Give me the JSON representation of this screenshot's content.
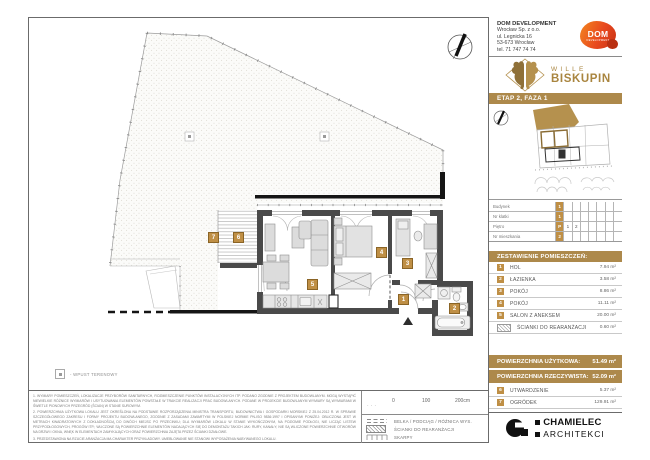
{
  "header": {
    "company_name": "DOM DEVELOPMENT",
    "company_line1": "Wrocław Sp. z o.o.",
    "company_line2": "ul. Legnicka 16",
    "company_line3": "53-673 Wrocław",
    "company_line4": "tel. 71 747 74 74",
    "dom_logo_text": "DOM",
    "dom_logo_sub": "DEVELOPMENT"
  },
  "brand": {
    "line1": "WILLE",
    "line2": "BISKUPIN"
  },
  "stage": "ETAP 2, FAZA 1",
  "unit_table": {
    "rows": [
      {
        "label": "Budynek",
        "value": "1",
        "opt1": "",
        "opt2": ""
      },
      {
        "label": "Nr klatki",
        "value": "1",
        "opt1": "",
        "opt2": ""
      },
      {
        "label": "Piętro",
        "value": "P",
        "opt1": "1",
        "opt2": "2"
      },
      {
        "label": "Nr mieszkania",
        "value": "2",
        "opt1": "",
        "opt2": ""
      }
    ]
  },
  "rooms": {
    "title": "ZESTAWIENIE POMIESZCZEŃ:",
    "items": [
      {
        "num": "1",
        "name": "HOL",
        "area": "7.94 m²"
      },
      {
        "num": "2",
        "name": "ŁAZIENKA",
        "area": "3.58 m²"
      },
      {
        "num": "3",
        "name": "POKÓJ",
        "area": "8.86 m²"
      },
      {
        "num": "4",
        "name": "POKÓJ",
        "area": "11.11 m²"
      },
      {
        "num": "5",
        "name": "SALON Z ANEKSEM",
        "area": "20.00 m²"
      },
      {
        "num": "",
        "name": "ŚCIANKI DO REARANŻACJI",
        "area": "0.60 m²"
      }
    ]
  },
  "totals": {
    "usable_label": "POWIERZCHNIA UŻYTKOWA:",
    "usable_value": "51.49 m²",
    "actual_label": "POWIERZCHNIA RZECZYWISTA:",
    "actual_value": "52.09 m²"
  },
  "outdoor": {
    "items": [
      {
        "num": "6",
        "name": "UTWARDZENIE",
        "area": "5.37 m²"
      },
      {
        "num": "7",
        "name": "OGRÓDEK",
        "area": "129.91 m²"
      }
    ]
  },
  "architect": {
    "line1": "CHAMIELEC",
    "line2": "ARCHITEKCI"
  },
  "plan": {
    "markers": [
      "1",
      "2",
      "3",
      "4",
      "5",
      "6",
      "7"
    ],
    "wpust_legend": "- WPUST TERENOWY"
  },
  "scalebar": {
    "t0": "0",
    "t1": "100",
    "t2": "200cm"
  },
  "legend": {
    "items": [
      {
        "label": "BELKA / PODCIĄG / RÓŻNICA WYS."
      },
      {
        "label": "ŚCIANKI DO REARANŻACJI"
      },
      {
        "label": "SKARPY"
      }
    ]
  },
  "disclaimer": {
    "p1": "1. WYMIARY POMIESZCZEŃ, LOKALIZACJE PRZYBORÓW SANITARNYCH, ROZMIESZCZENIE PUNKTÓW INSTALACYJNYCH ITP. PODANO ZGODNIE Z PROJEKTEM BUDOWLANYM. MOGĄ WYSTĄPIĆ NIEWIELKIE RÓŻNICE WYMIARÓW I USYTUOWANIA ELEMENTÓW POWSTAŁE W TRAKCIE REALIZACJI PRAC BUDOWLANYCH. PODANE W PROJEKCIE BUDOWLANYM WYMIARY SĄ WYMIARAMI W ŚWIETLE PIONOWYCH PRZEGRÓD (ŚCIAN) W STANIE SUROWYM.",
    "p2": "2. POWIERZCHNIA UŻYTKOWA LOKALU JEST OKREŚLONA NA PODSTAWIE ROZPORZĄDZENIA MINISTRA TRANSPORTU, BUDOWNICTWA I GOSPODARKI MORSKIEJ Z 25.04.2012 R. W SPRAWIE SZCZEGÓŁOWEGO ZAKRESU I FORMY PROJEKTU BUDOWLANEGO, ZGODNIE Z ZASADAMI ZAWARTYMI W POLSKIEJ NORMIE PN-ISO 9836:1997 I OPISANYMI PONIŻEJ: OBLICZONA JEST W METRACH KWADRATOWYCH Z DOKŁADNOŚCIĄ DO DWÓCH MIEJSC PO PRZECINKU; DLA WYMIARÓW LOKALU W STANIE WYKOŃCZONYM, NA POZIOMIE PODŁOGI, NIE LICZĄC LISTEW PRZYPODŁOGOWYCH, PROGÓW ITP.; WLICZONE SĄ POWIERZCHNIE ELEMENTÓW NADAJĄCYCH SIĘ DO DEMONTAŻU TAKICH JAK: RURY, KANAŁY; NIE SĄ WLICZONE POWIERZCHNIE OTWORÓW NA DRZWI I OKNA, WNĘK W ELEMENTACH ZAMYKAJĄCYCH ORAZ POWIERZCHNIA ZAJĘTA PRZEZ ŚCIANKI DZIAŁOWE.",
    "p3": "3. PRZEDSTAWIONA NA RZUCIE ARANŻACJA MA CHARAKTER PRZYKŁADOWY. UMEBLOWANIE NIE STANOWI WYPOSAŻENIA NABYWANEGO LOKALU."
  },
  "colors": {
    "gold": "#ad894b",
    "marker_gold": "#bf8f45",
    "dom_orange": "#e8491f",
    "wall": "#4a4a4a"
  }
}
